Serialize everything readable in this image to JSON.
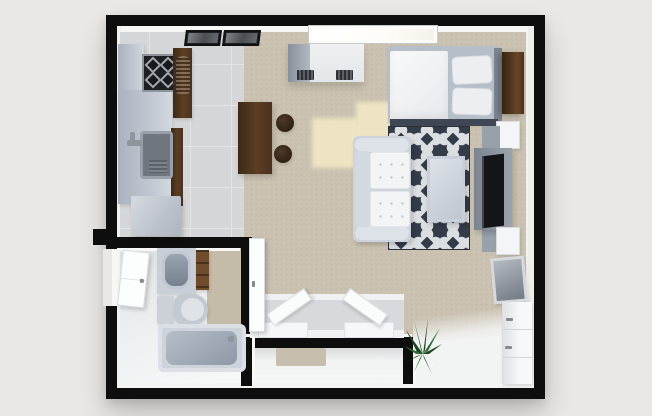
{
  "scene": {
    "type": "3d-floor-plan-top-down-render",
    "title": "Studio apartment 3D floor plan",
    "background_color": "#e9e8e6",
    "wall_color": "#0e0e0e"
  },
  "palette": {
    "bg": "#e9e8e6",
    "wall": "#0e0e0e",
    "tile": "#d4d6d8",
    "carpet": "#cbc2b1",
    "bath-floor": "#e8eaec",
    "entry-floor": "#f1f2f2",
    "rug-base": "#343b49",
    "rug-motif": "#dcdfe2",
    "sofa-base": "#cdd3db",
    "cushion": "#f2f4f6",
    "wood": "#5d3e22",
    "counter": "#b9c1cd",
    "white-furn": "#f4f5f6",
    "tv": "#131519",
    "mattress": "#b6bec9",
    "duvet": "#f5f6f8",
    "plant-green": "#2b6433",
    "sunlight": "#f7edc8"
  },
  "rooms": [
    {
      "id": "kitchen",
      "label": "Kitchen",
      "floor": "gray-tile",
      "items": [
        "stove-cooktop",
        "tall-cabinet-with-appliance",
        "counter",
        "sink",
        "faucet",
        "refrigerator",
        "wall-art-frame",
        "wall-art-frame",
        "vent-console",
        "window",
        "dining-table",
        "bar-stool",
        "bar-stool"
      ]
    },
    {
      "id": "sleeping-area",
      "label": "Sleeping area",
      "floor": "carpet",
      "items": [
        "bed",
        "duvet",
        "pillow",
        "pillow",
        "headboard",
        "wardrobe",
        "nightstand"
      ]
    },
    {
      "id": "living-area",
      "label": "Living area",
      "floor": "carpet",
      "items": [
        "sofa",
        "coffee-table",
        "patterned-area-rug",
        "tv",
        "tv-console",
        "side-stand",
        "side-stand",
        "lamp-box",
        "leaning-mirror",
        "drawer-dresser",
        "lounge-chair",
        "lounge-chair",
        "chair-mat",
        "potted-plant",
        "sunlight-patch",
        "sunlight-patch"
      ]
    },
    {
      "id": "bathroom",
      "label": "Bathroom",
      "floor": "gray-and-tan",
      "items": [
        "vanity-sink",
        "storage-shelf",
        "toilet",
        "bathtub",
        "door-leaf"
      ]
    },
    {
      "id": "entry-hall",
      "label": "Entry hall",
      "floor": "white",
      "items": [
        "doormat",
        "entry-door-leaf"
      ]
    }
  ]
}
